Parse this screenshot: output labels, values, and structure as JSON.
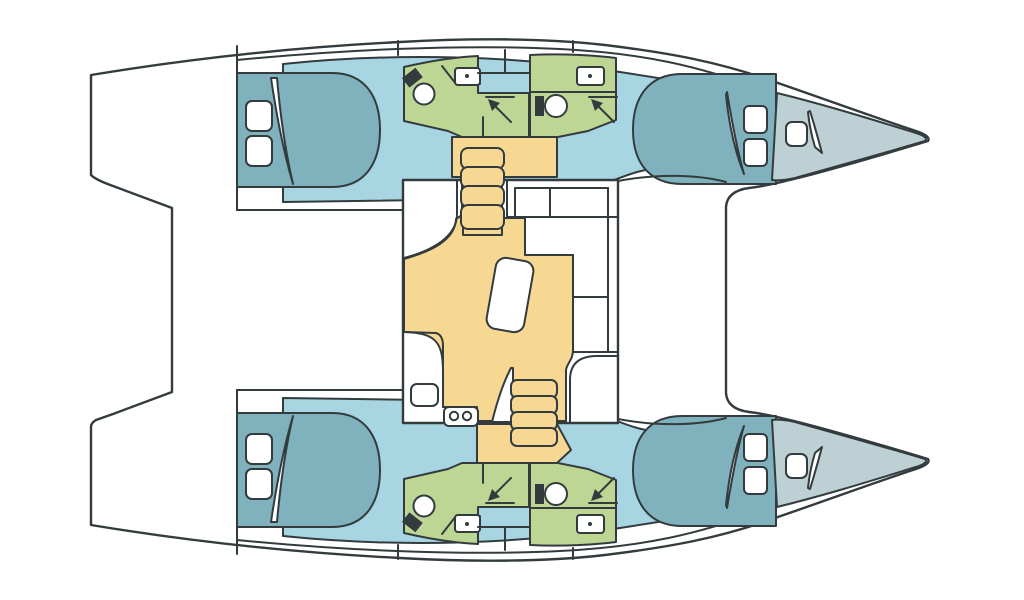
{
  "diagram": {
    "type": "boat-floor-plan",
    "subject": "catamaran interior layout, top view, bow pointing right",
    "colors": {
      "outline": "#333b3e",
      "hull_white": "#ffffff",
      "cabin_floor_blue": "#a7d6e2",
      "berth_teal": "#7fb2bd",
      "bathroom_green": "#bdd694",
      "salon_floor_yellow": "#f7d893",
      "forepeak_gray": "#bdd0d3",
      "fixture_white": "#ffffff"
    },
    "port_hull": {
      "aft_cabin": {
        "label": "aft double cabin",
        "berth": "double berth",
        "pillows": 2,
        "blanket_fold": true
      },
      "aft_bathroom": {
        "fixtures": [
          "toilet",
          "washbasin-with-counter",
          "shower-with-drain-arrow"
        ]
      },
      "forward_bathroom": {
        "fixtures": [
          "toilet",
          "washbasin-with-counter",
          "shower-with-drain-arrow"
        ]
      },
      "companionway_hatch": {
        "position": "between bathrooms, deck side"
      },
      "forward_cabin": {
        "label": "forward double cabin",
        "berth": "double berth",
        "pillows": 2,
        "blanket_fold": true
      },
      "forepeak": {
        "label": "bow compartment",
        "features": [
          "deck-hatch",
          "access-door"
        ]
      }
    },
    "starboard_hull": {
      "mirrors": "port_hull"
    },
    "saloon": {
      "label": "main saloon and galley",
      "galley": {
        "fixtures": [
          "sink",
          "two-burner-stove"
        ],
        "burners": 2
      },
      "dinette": {
        "table": "rectangular table",
        "sofa": "L-shaped sofa with cushions"
      },
      "forward_counter": {
        "cells": 2
      },
      "aft_cabinet": true,
      "companionways": [
        {
          "side": "port",
          "steps": 4
        },
        {
          "side": "starboard",
          "steps": 4
        }
      ]
    },
    "totals": {
      "hulls": 2,
      "cabins": 4,
      "bathrooms": 4,
      "berths": 4,
      "companionway_steps_each": 4
    }
  }
}
